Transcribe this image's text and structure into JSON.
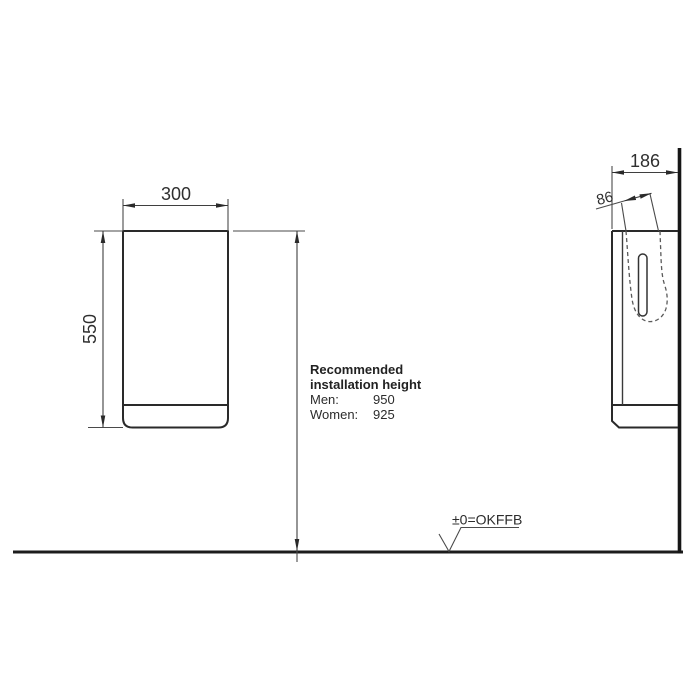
{
  "drawing": {
    "type": "technical-installation-drawing",
    "front_view": {
      "width_dim": "300",
      "height_dim": "550"
    },
    "side_view": {
      "depth_dim": "186",
      "offset_dim": "86"
    },
    "installation_note": {
      "title_line1": "Recommended",
      "title_line2": "installation height",
      "rows": [
        {
          "label": "Men:",
          "value": "950"
        },
        {
          "label": "Women:",
          "value": "925"
        }
      ]
    },
    "floor": {
      "level_label": "±0=OKFFB"
    },
    "colors": {
      "line": "#1c1c1c",
      "thin_line": "#4a4a4a",
      "hidden_line": "#5a5a5a",
      "text": "#2f2f2f",
      "background": "#ffffff"
    }
  }
}
